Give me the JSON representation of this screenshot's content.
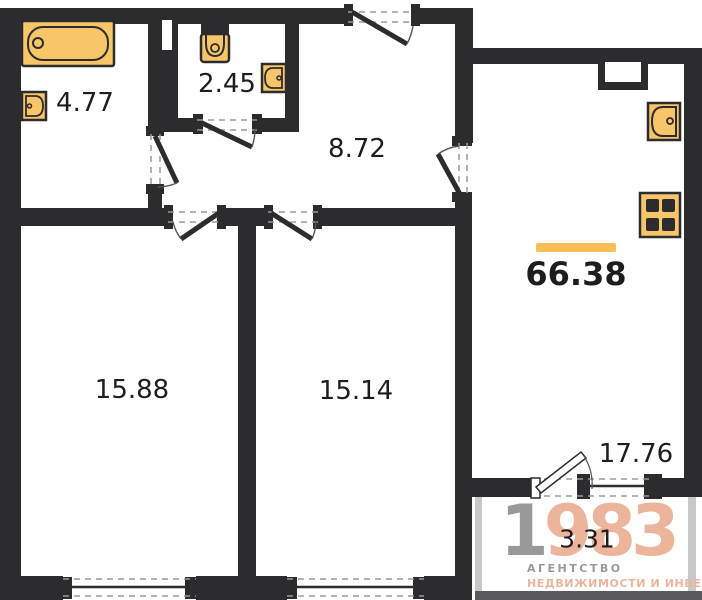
{
  "title": "apartment-floor-plan",
  "areas": {
    "total": "66.38",
    "bathroom": "4.77",
    "toilet": "2.45",
    "hallway": "8.72",
    "room_left": "15.88",
    "room_middle": "15.14",
    "kitchen_living": "17.76",
    "balcony": "3.31"
  },
  "logo": {
    "digit_gray": "1",
    "digits_accent": "983",
    "line1": "АГЕНТСТВО",
    "line2": "НЕДВИЖИМОСТИ И ИНВЕСТИЦИЙ"
  },
  "colors": {
    "wall": "#2C2C2E",
    "fixture_fill": "#F8C568",
    "accent_bar": "#F9BE55",
    "logo_gray": "#98999B",
    "logo_accent": "#EDB49C",
    "balcony_border": "#C8C8CA",
    "balcony_base": "#59595B",
    "label_text": "#1d1d1f"
  }
}
